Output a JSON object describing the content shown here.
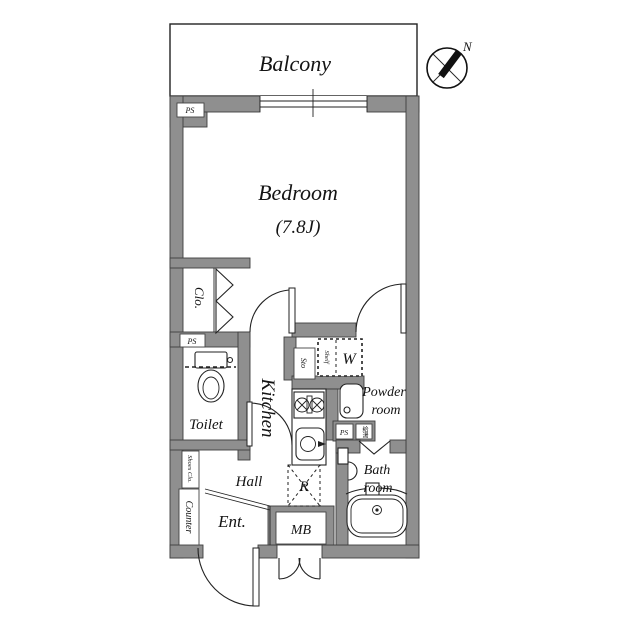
{
  "diagram_type": "apartment-floor-plan",
  "colors": {
    "wall_fill": "#8f8f8f",
    "line": "#222222",
    "background": "#ffffff"
  },
  "compass": {
    "north_label": "N"
  },
  "rooms": {
    "balcony": {
      "label": "Balcony"
    },
    "bedroom": {
      "label": "Bedroom",
      "size": "(7.8J)"
    },
    "closet": {
      "label": "Clo."
    },
    "toilet": {
      "label": "Toilet"
    },
    "kitchen": {
      "label": "Kitchen"
    },
    "hall": {
      "label": "Hall"
    },
    "entrance": {
      "label": "Ent."
    },
    "powder_room": {
      "label_line1": "Powder",
      "label_line2": "room"
    },
    "bath_room": {
      "label_line1": "Bath",
      "label_line2": "room"
    }
  },
  "features": {
    "pipe_space_top": "PS",
    "pipe_space_closet": "PS",
    "pipe_space_powder": "PS",
    "water_heater": "給湯",
    "storage": "Sto",
    "shelf": "Shelf",
    "washing_machine": "W",
    "refrigerator": "R",
    "meter_box": "MB",
    "shoes_closet": "Shoes Clo.",
    "counter": "Counter"
  }
}
